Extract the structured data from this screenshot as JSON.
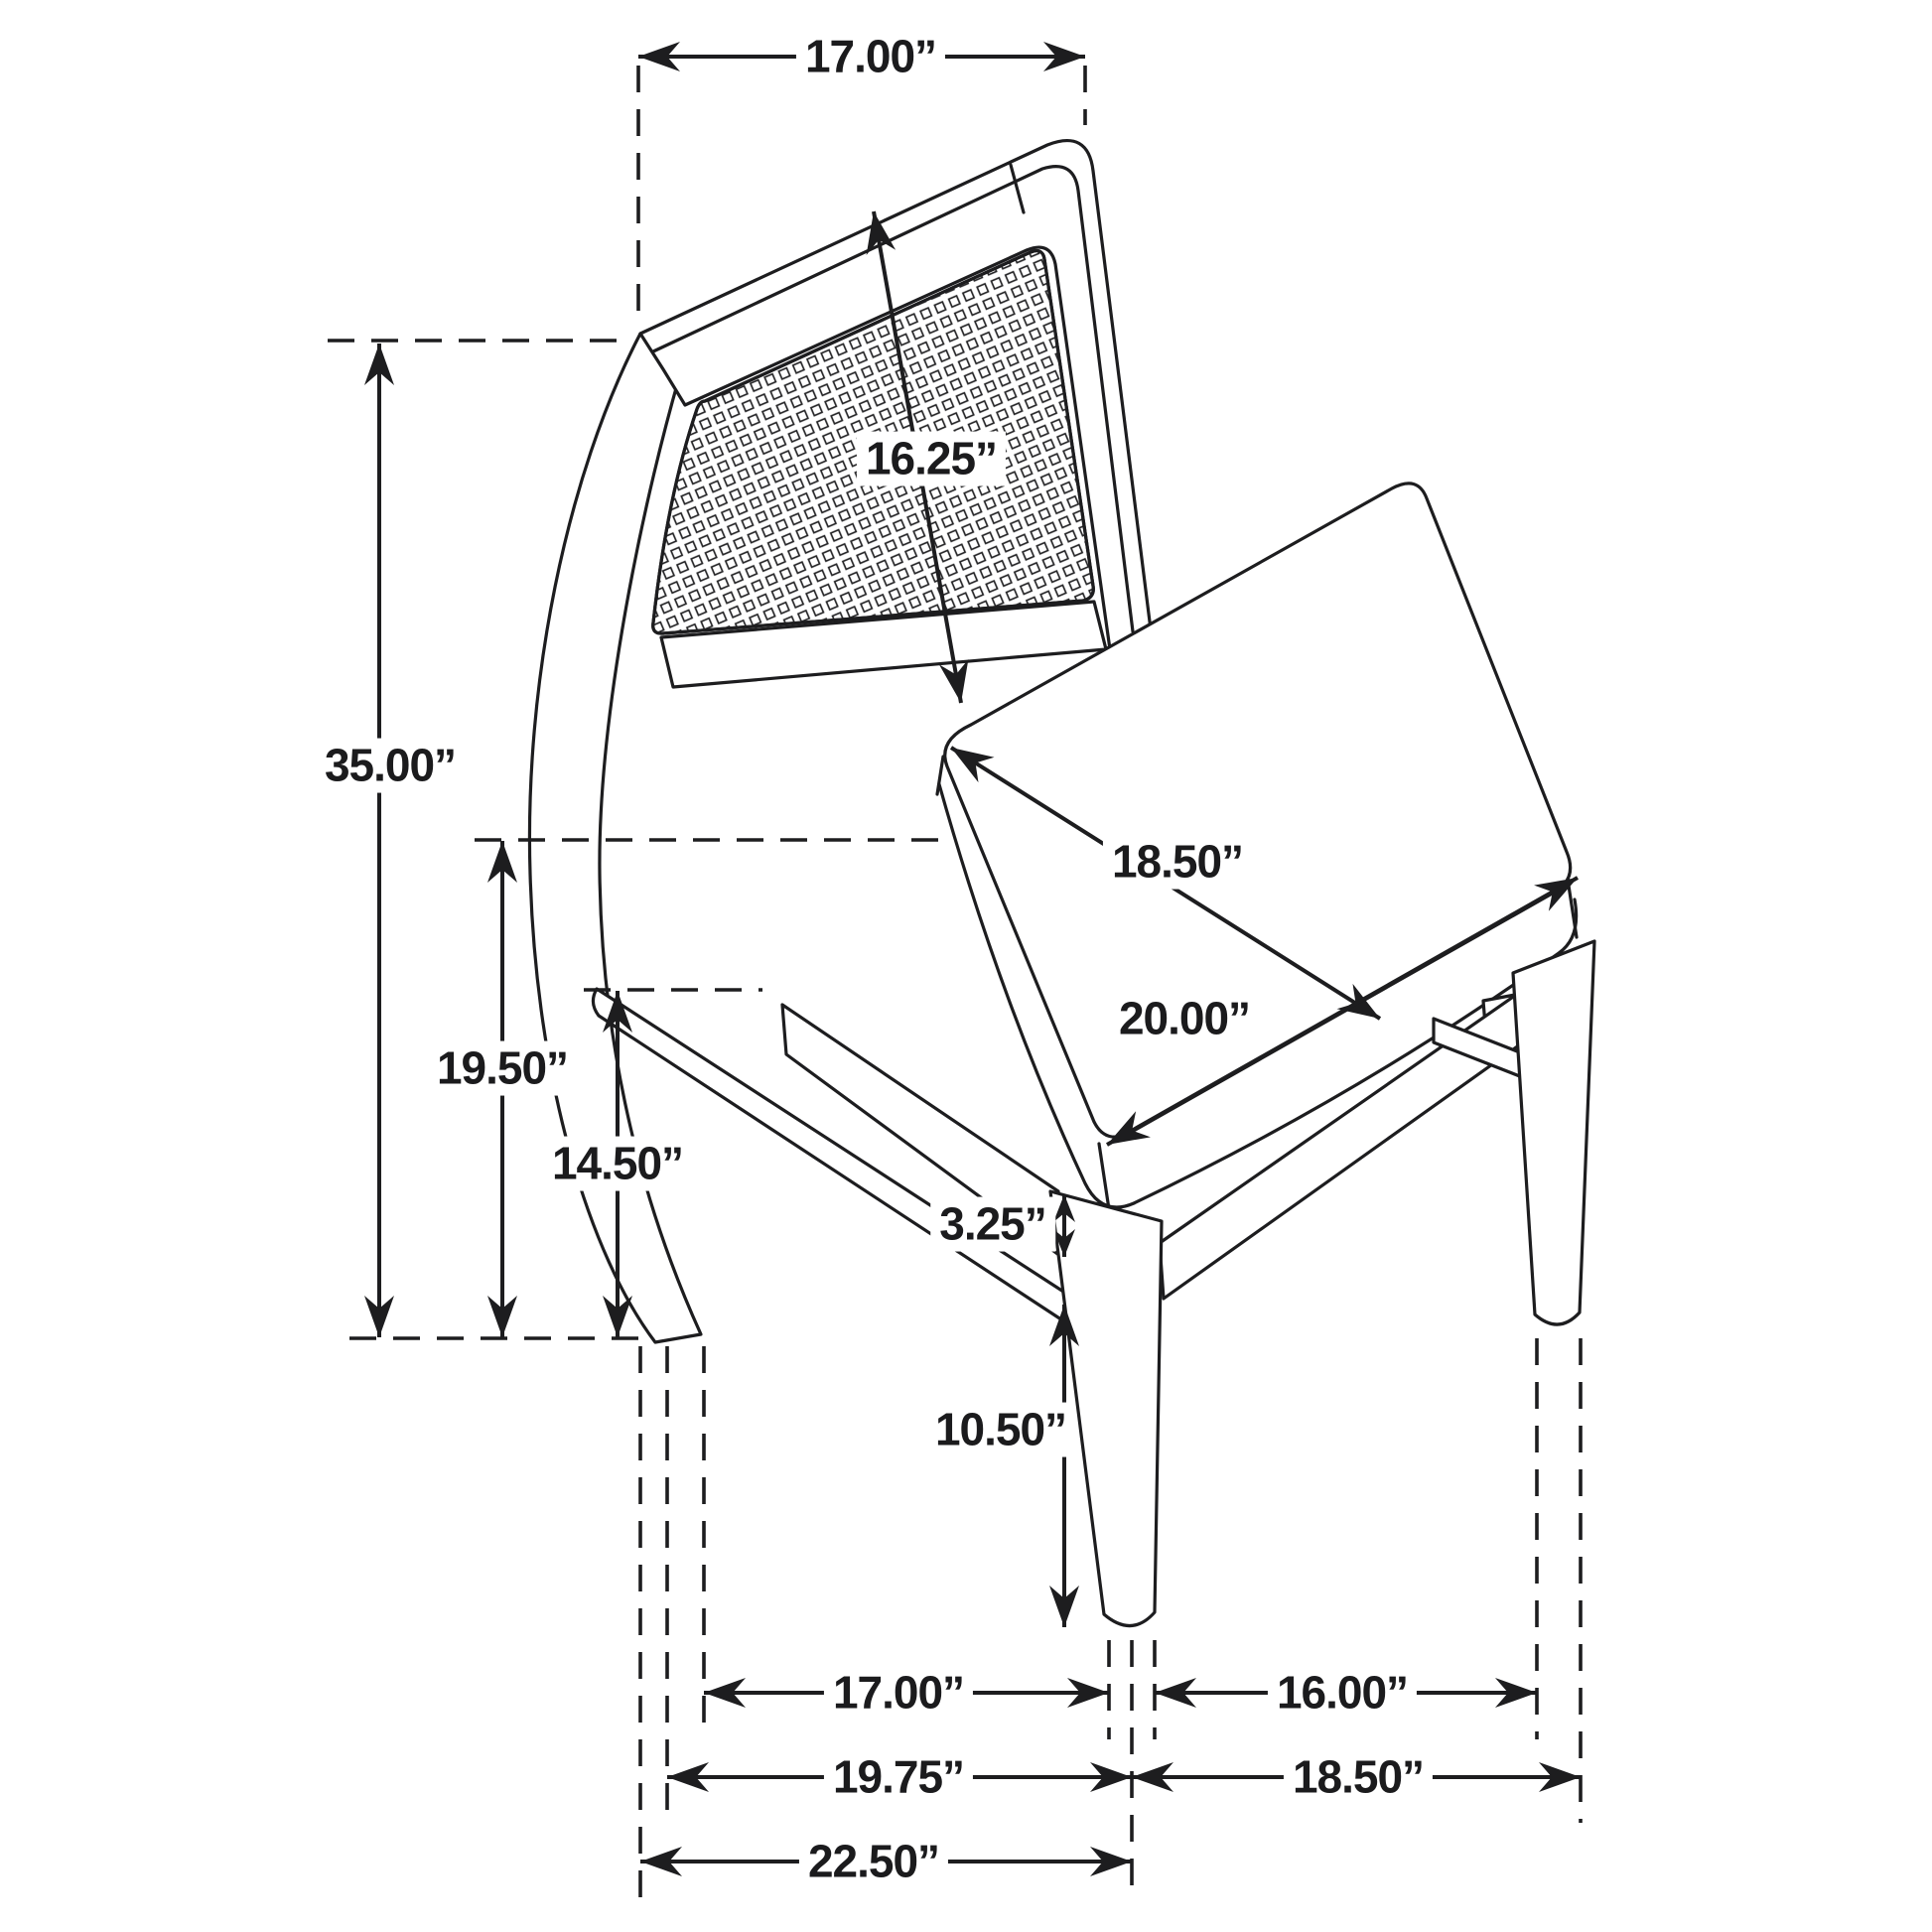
{
  "diagram": {
    "kind": "product-dimension-diagram",
    "subject": "cane-back dining side chair line drawing",
    "unit": "inches",
    "line_color": "#1d1d1f",
    "background_color": "#ffffff"
  },
  "labels": {
    "back_width": "17.00”",
    "back_panel_height": "16.25”",
    "overall_height": "35.00”",
    "seat_height": "19.50”",
    "rear_stretcher_height": "14.50”",
    "seat_depth": "18.50”",
    "seat_width": "20.00”",
    "apron_thickness": "3.25”",
    "front_leg_height": "10.50”",
    "leg_span_side": "17.00”",
    "leg_span_front": "16.00”",
    "base_depth": "19.75”",
    "base_width": "18.50”",
    "overall_depth": "22.50”"
  }
}
